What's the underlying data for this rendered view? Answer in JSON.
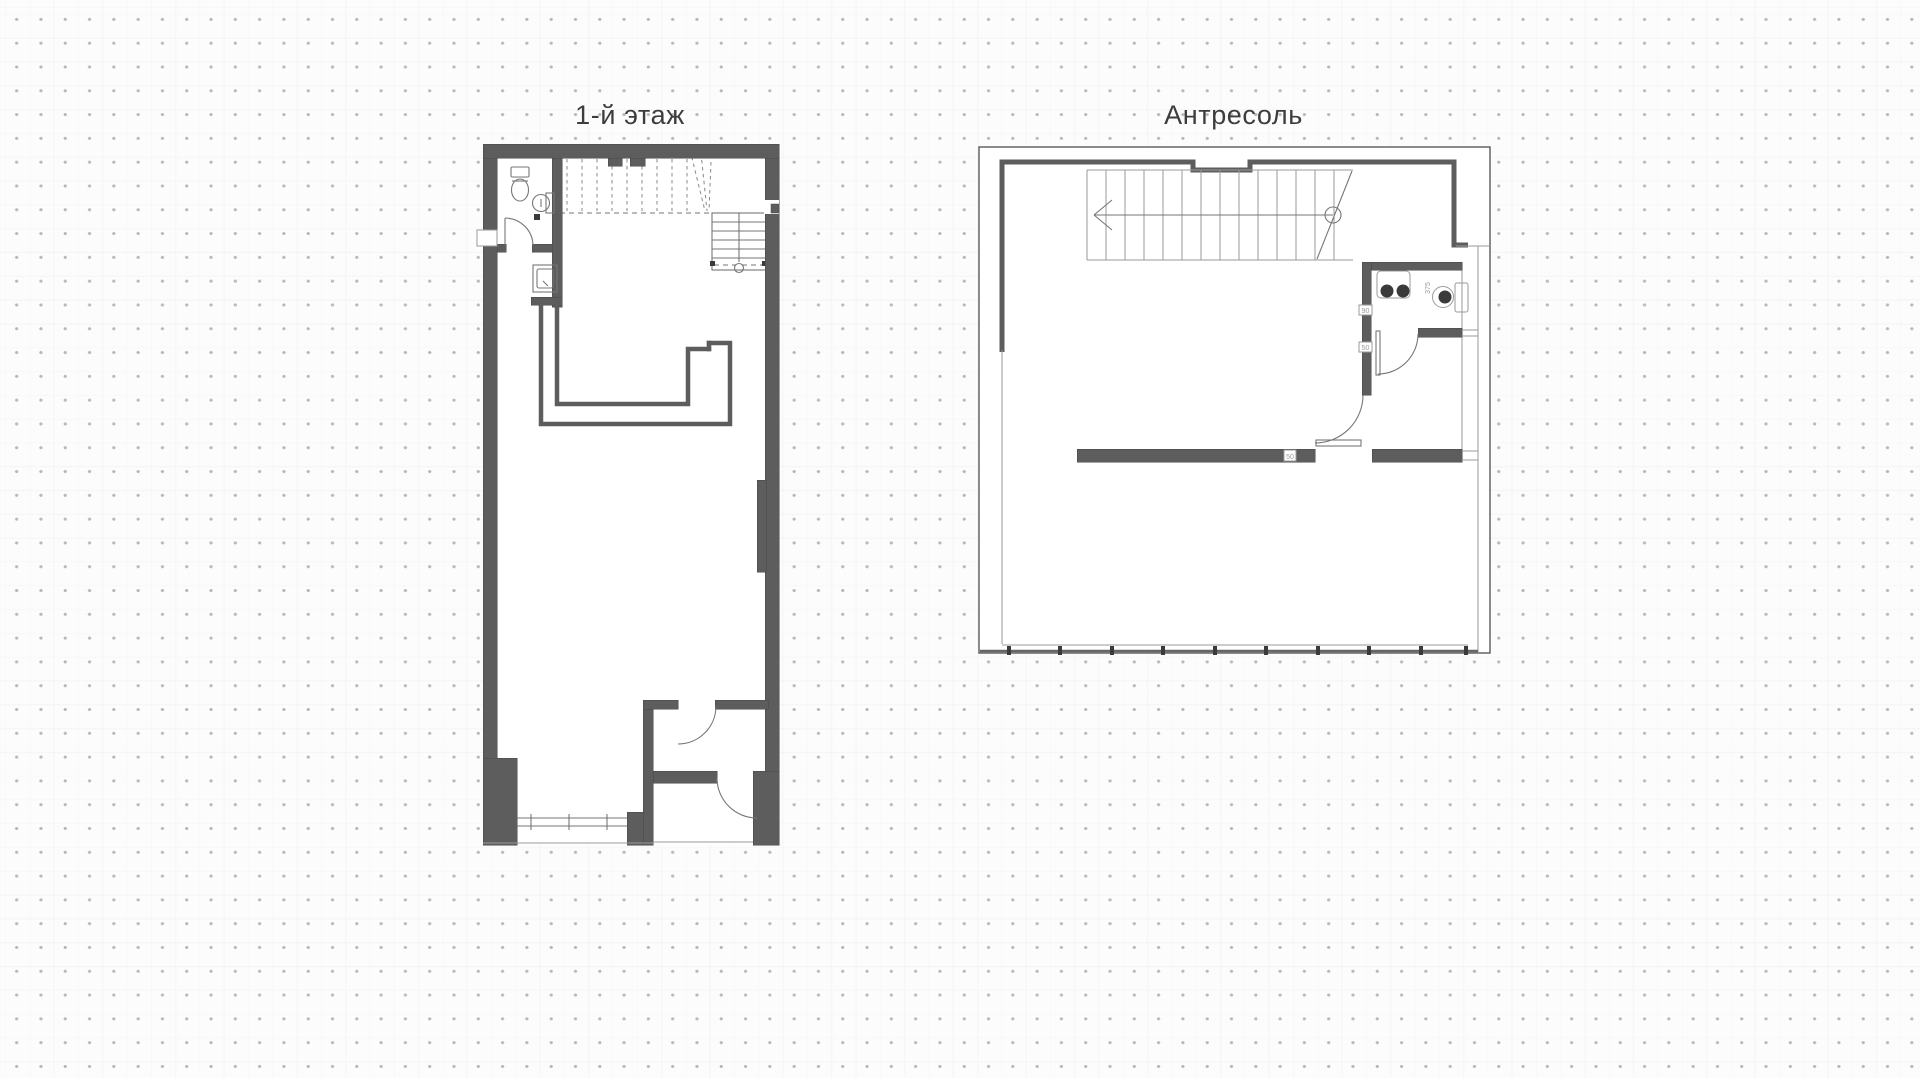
{
  "page": {
    "description": "Two architectural floor plans on a dotted grid background"
  },
  "colors": {
    "background": "#fcfcfc",
    "dot": "#b9b9b9",
    "title": "#3d3d3d",
    "wall": "#5d5d5d",
    "wall_edge": "#484848",
    "line": "#767676",
    "line_light": "#9a9a9a",
    "fixture_dark": "#3a3a3a"
  },
  "plans": {
    "first_floor": {
      "title": "1-й этаж"
    },
    "mezzanine": {
      "title": "Антресоль",
      "labels": {
        "dim_375": "375",
        "dim_90": "90",
        "dim_50": "50",
        "wall_50": "50"
      }
    }
  }
}
